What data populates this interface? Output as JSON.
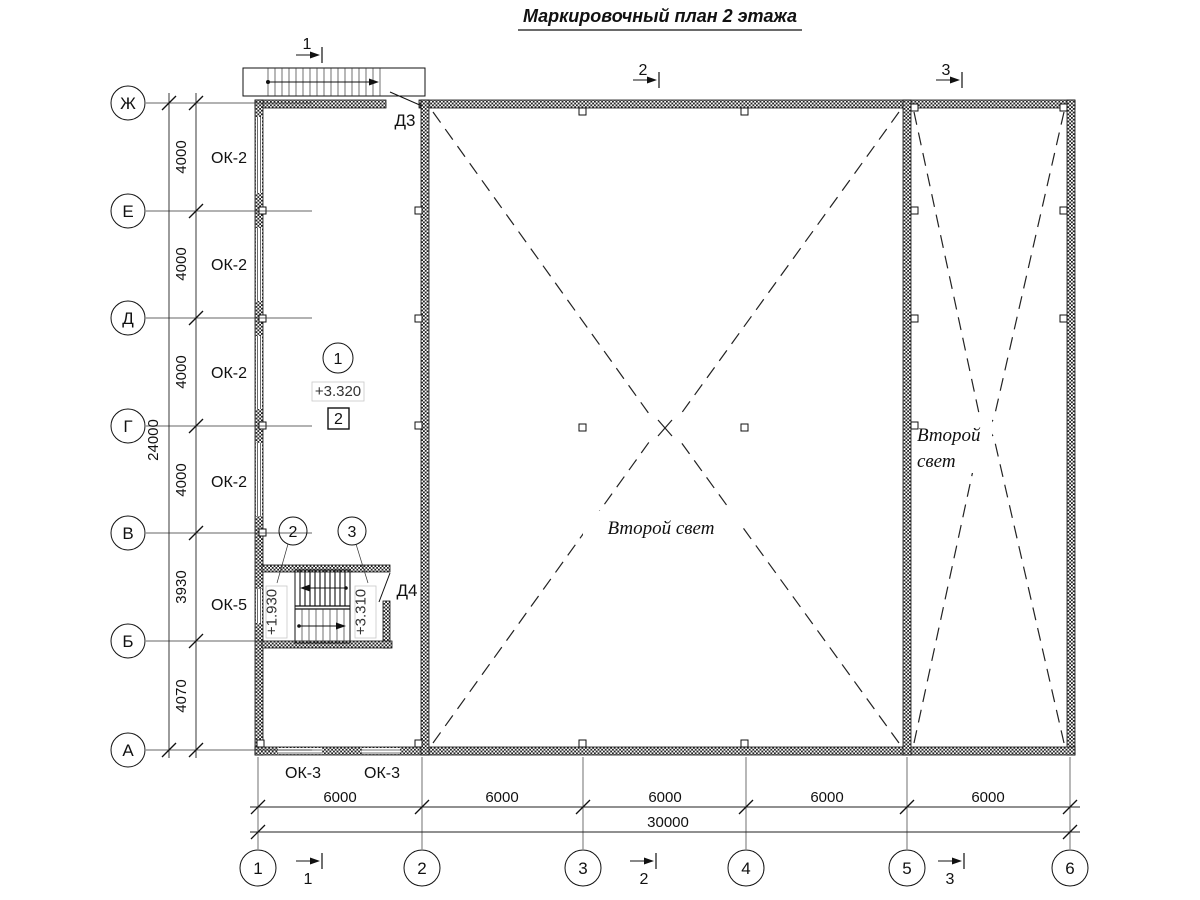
{
  "title": {
    "text": "Маркировочный план 2 этажа"
  },
  "axes": {
    "rows": [
      "Ж",
      "Е",
      "Д",
      "Г",
      "В",
      "Б",
      "А"
    ],
    "cols": [
      "1",
      "2",
      "3",
      "4",
      "5",
      "6"
    ]
  },
  "dimensions": {
    "vertical_segments": [
      "4000",
      "4000",
      "4000",
      "4000",
      "3930",
      "4070"
    ],
    "vertical_total": "24000",
    "horizontal_segments": [
      "6000",
      "6000",
      "6000",
      "6000",
      "6000"
    ],
    "horizontal_total": "30000"
  },
  "windows": {
    "ok2_labels": [
      "ОК-2",
      "ОК-2",
      "ОК-2",
      "ОК-2"
    ],
    "ok5_label": "ОК-5",
    "ok3_labels": [
      "ОК-3",
      "ОК-3"
    ]
  },
  "doors": {
    "d3": "Д3",
    "d4": "Д4"
  },
  "levels": {
    "floor": "+3.320",
    "stair_flight1": "+1.930",
    "stair_flight2": "+3.310"
  },
  "markers": {
    "room_number": "1",
    "detail_box": "2",
    "stair_marker_left": "2",
    "stair_marker_right": "3"
  },
  "sections": {
    "s1": "1",
    "s2": "2",
    "s3": "3"
  },
  "annotations": {
    "second_light_center": "Второй свет",
    "second_light_right_line1": "Второй",
    "second_light_right_line2": "свет"
  },
  "colors": {
    "line": "#1a1a1a",
    "background": "#ffffff"
  }
}
